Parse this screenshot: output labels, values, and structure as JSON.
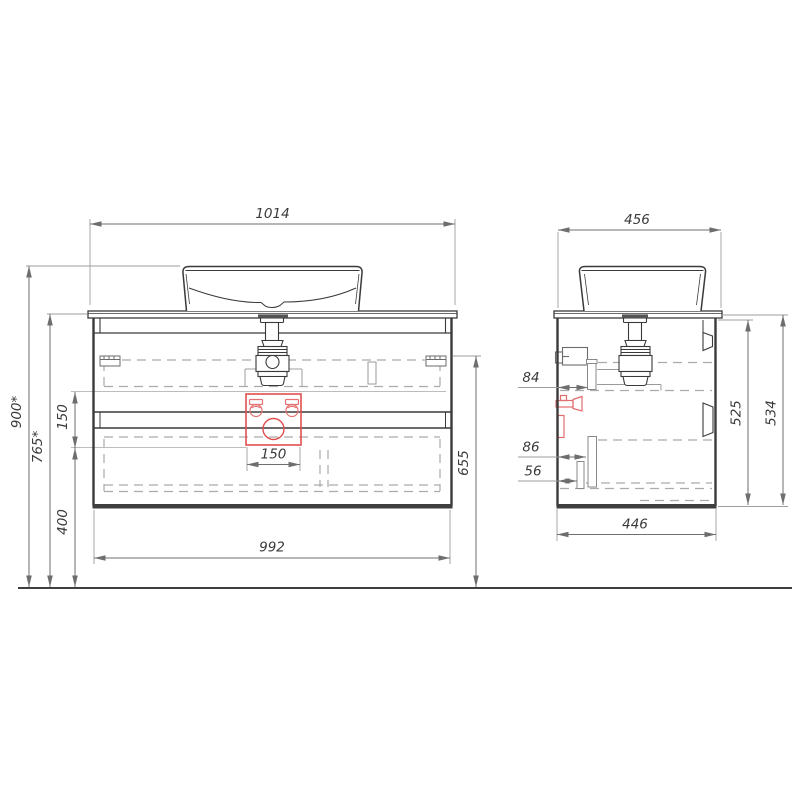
{
  "drawing": {
    "kind": "technical-dimension-drawing",
    "subject": "wall-hung vanity cabinet with vessel basin, front and side projections",
    "colors": {
      "line": "#3a3a3a",
      "dim_line": "#6e6e6e",
      "extension": "#9e9e9e",
      "dashed": "#ababab",
      "red_accent": "#e04f4f",
      "red_light": "#e57373",
      "background": "#ffffff"
    },
    "dimensions": {
      "front": {
        "top_width": "1014",
        "bottom_width": "992",
        "overall_height": "900*",
        "counter_height": "765*",
        "opening_height": "150",
        "opening_width": "150",
        "under_clearance": "400",
        "drawer_zone_height": "655"
      },
      "side": {
        "top_depth": "456",
        "bottom_depth": "446",
        "carcass_height": "525",
        "total_height": "534",
        "offset_top": "84",
        "offset_mid": "86",
        "offset_bottom": "56"
      }
    }
  }
}
